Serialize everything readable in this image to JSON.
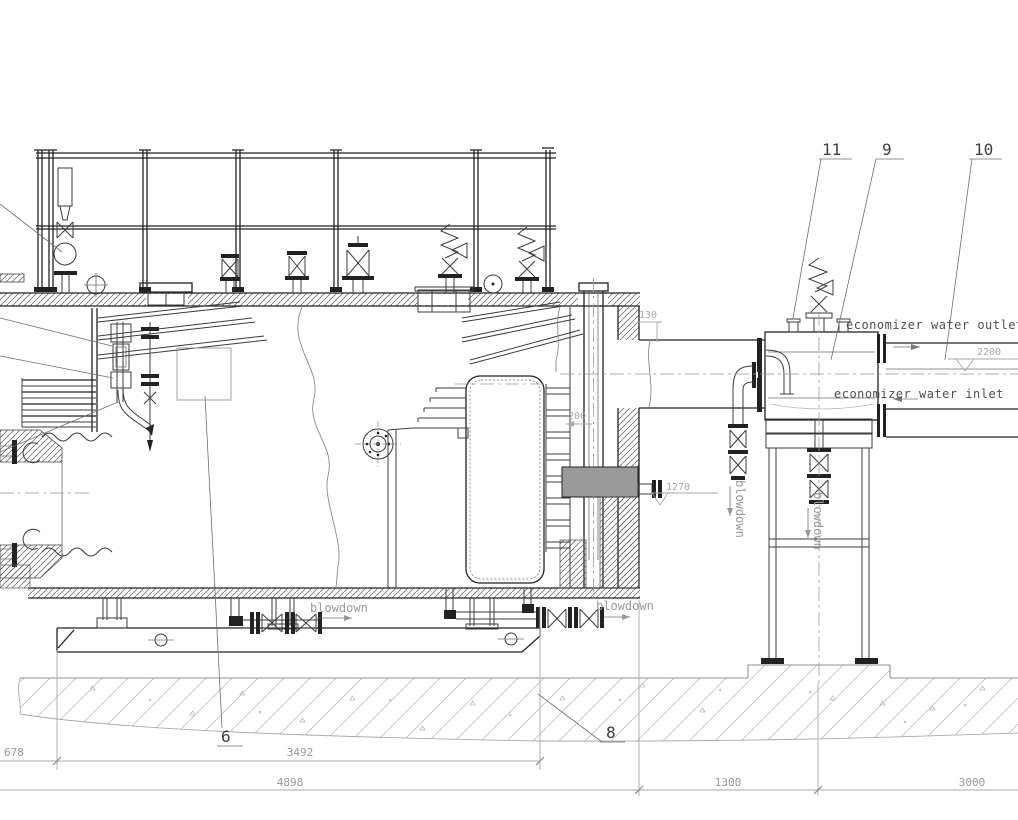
{
  "drawing": {
    "type": "boiler-economizer-side-elevation",
    "units": "mm",
    "colors": {
      "line": "#222222",
      "dim_line": "#aaaaaa",
      "dim_text": "#989898",
      "label_text": "#4f4f4f",
      "centerline": "#999999",
      "background": "#ffffff"
    },
    "callouts": {
      "c6": "6",
      "c8": "8",
      "c9": "9",
      "c10": "10",
      "c11": "11"
    },
    "labels": {
      "economizer_water_outlet": "economizer water outlet",
      "economizer_water_inlet": "economizer water inlet",
      "blowdown_front": "blowdown",
      "blowdown_rear": "blowdown",
      "blowdown_duct_drain": "blowdown",
      "blowdown_economizer_drain": "blowdown"
    },
    "levels": {
      "economizer_outlet": "2200",
      "duct_bottom": "1270"
    },
    "dimensions": {
      "front_overhang": "678",
      "skid_length": "3492",
      "boiler_length": "4898",
      "boiler_to_economizer": "1300",
      "economizer_bay": "3000",
      "flue_offset": "130",
      "drum_wall_gap": "200"
    }
  }
}
